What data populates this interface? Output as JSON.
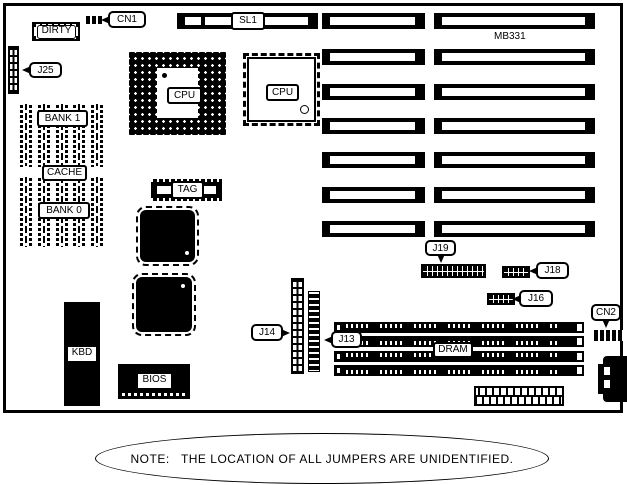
{
  "diagram": {
    "type": "motherboard-layout",
    "board_model": "MB331",
    "isa_slot_rows": 7,
    "simm_slots": 4,
    "cache_sockets_per_bank": 5
  },
  "labels": {
    "cn1": "CN1",
    "dirty": "DIRTY",
    "j25": "J25",
    "bank1": "BANK 1",
    "cache": "CACHE",
    "bank0": "BANK 0",
    "cpu_socket": "CPU",
    "cpu_qfp": "CPU",
    "sl1": "SL1",
    "model": "MB331",
    "tag": "TAG",
    "j19": "J19",
    "j18": "J18",
    "j16": "J16",
    "cn2": "CN2",
    "j14": "J14",
    "j13": "J13",
    "dram": "DRAM",
    "kbd": "KBD",
    "bios": "BIOS"
  },
  "note": "NOTE:   THE LOCATION OF ALL JUMPERS ARE UNIDENTIFIED.",
  "colors": {
    "line": "#000000",
    "background": "#ffffff"
  }
}
